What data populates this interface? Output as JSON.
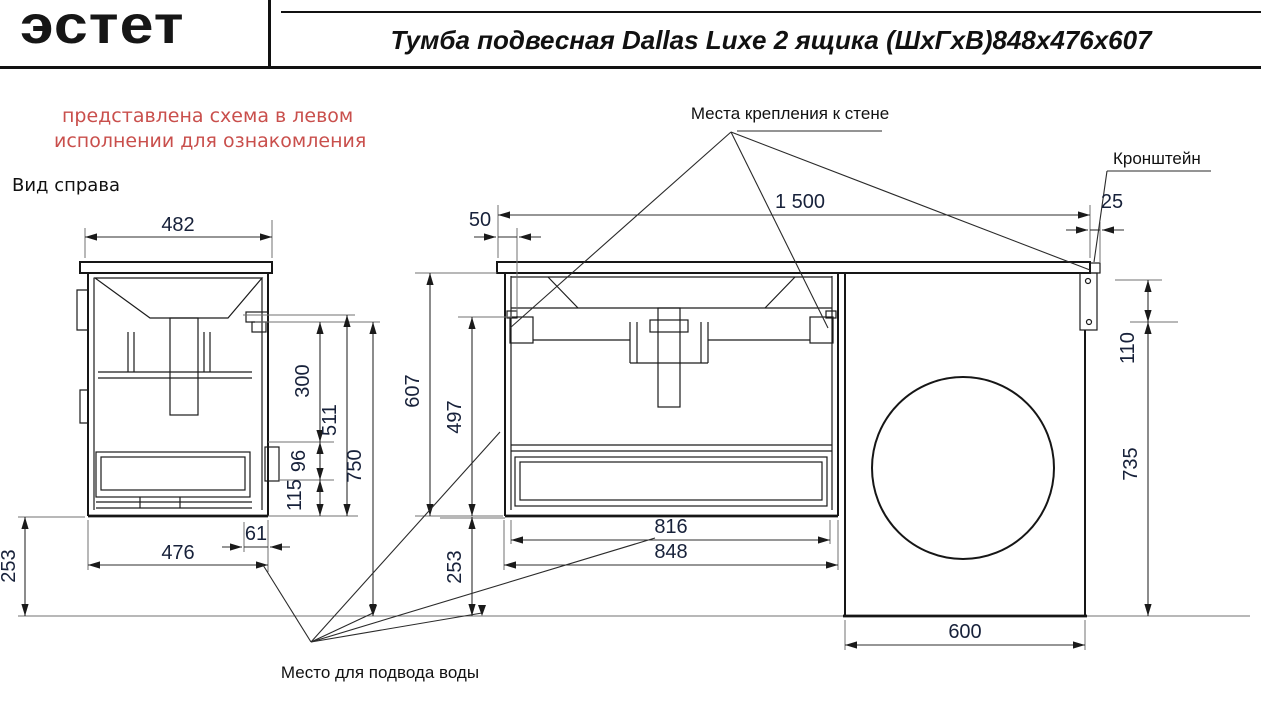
{
  "header": {
    "logo": "эстет",
    "title": "Тумба подвесная Dallas Luxe 2 ящика (ШхГхВ)848х476х607"
  },
  "annotations": {
    "disclaimer_line1": "представлена схема в левом",
    "disclaimer_line2": "исполнении для ознакомления",
    "side_view_title": "Вид справа",
    "wall_mount_label": "Места крепления к стене",
    "bracket_label": "Кронштейн",
    "water_supply_label": "Место для подвода воды"
  },
  "colors": {
    "accent_red": "#c94f4c",
    "line": "#161616"
  },
  "dims": {
    "side_top_width": "482",
    "side_bottom_width": "476",
    "side_front_offset": "61",
    "side_floor_gap": "253",
    "side_upper": "300",
    "side_mid": "511",
    "side_total": "750",
    "side_handle": "96",
    "side_lower": "115",
    "front_top_width": "1 500",
    "front_mount_offset": "50",
    "front_height": "607",
    "front_inner_height": "497",
    "front_floor_gap": "253",
    "front_inner_width": "816",
    "front_width": "848",
    "niche_gap": "110",
    "niche_height": "735",
    "niche_width": "600",
    "bracket_offset": "25"
  }
}
